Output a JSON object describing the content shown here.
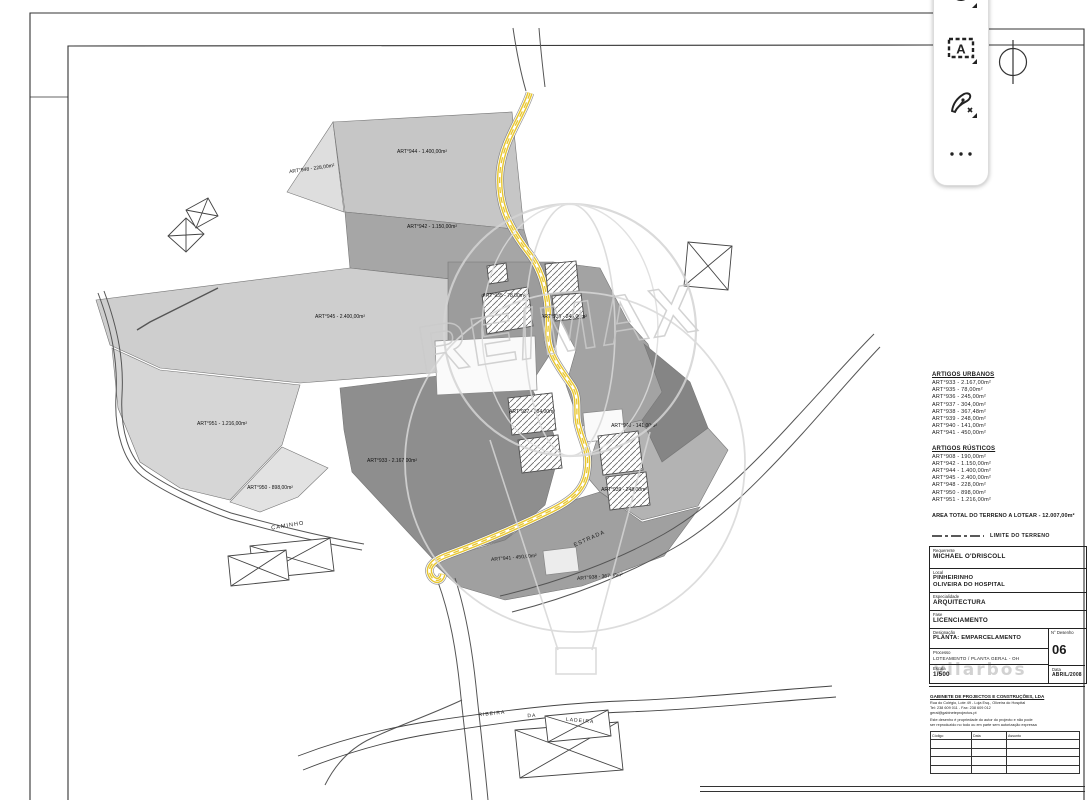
{
  "toolbar": {
    "icons": [
      "rotate-icon",
      "text-selection-icon",
      "pen-icon",
      "more-options-icon"
    ]
  },
  "plan": {
    "watermark": "RE/MAX",
    "caminho": "CAMINHO",
    "estrada": "ESTRADA",
    "stream": [
      "RIBEIRA",
      "DA",
      "LADEIRA"
    ],
    "labels": [
      "ART°948 - 228,00m²",
      "ART°944 - 1.400,00m²",
      "ART°942 - 1.150,00m²",
      "ART°945 - 2.400,00m²",
      "ART°951 - 1.216,00m²",
      "ART°950 - 898,00m²",
      "ART°935 - 78,00m²",
      "ART°936 - 245,00m²",
      "ART°937 - 304,00m²",
      "ART°940 - 141,00m²",
      "ART°939 - 248,00m²",
      "ART°941 - 450,00m²",
      "ART°938 - 367,48m²",
      "ART°933 - 2.167,00m²"
    ]
  },
  "panel": {
    "urban_title": "ARTIGOS URBANOS",
    "urban": [
      "ART°933 - 2.167,00m²",
      "ART°935 - 78,00m²",
      "ART°936 - 245,00m²",
      "ART°937 - 304,00m²",
      "ART°938 - 367,48m²",
      "ART°939 - 248,00m²",
      "ART°940 - 141,00m²",
      "ART°941 - 450,00m²"
    ],
    "rustic_title": "ARTIGOS RÚSTICOS",
    "rustic": [
      "ART°908 - 190,00m²",
      "ART°942 - 1.150,00m²",
      "ART°944 - 1.400,00m²",
      "ART°945 - 2.400,00m²",
      "ART°948 - 228,00m²",
      "ART°950 - 898,00m²",
      "ART°951 - 1.216,00m²"
    ],
    "total": "AREA TOTAL DO TERRENO A LOTEAR - 12.007,00m²",
    "legend": "LIMITE DO TERRENO",
    "fields": {
      "requerente_label": "Requerente",
      "requerente": "MICHAEL O'DRISCOLL",
      "local_label": "Local",
      "local_line1": "PINHEIRINHO",
      "local_line2": "OLIVEIRA DO HOSPITAL",
      "especialidade_label": "Especialidade",
      "especialidade": "ARQUITECTURA",
      "fase_label": "Fase",
      "fase": "LICENCIAMENTO",
      "designacao_label": "Designação",
      "designacao": "PLANTA: EMPARCELAMENTO",
      "processo_label": "Processo",
      "processo": "LOTEAMENTO / PLANTA GERAL - OH",
      "num_label": "N° Desenho",
      "num": "06",
      "escala_label": "Escala",
      "escala": "1/500",
      "data_label": "Data",
      "data": "ABRIL/2008"
    },
    "firm_watermark": "vilarbos",
    "company": {
      "name": "GABINETE DE PROJECTOS E CONSTRUÇÕES, LDA",
      "addr1": "Rua do Colégio, Lote 49 - Loja Esq., Oliveira do Hospital",
      "addr2": "Tel: 238 609 011  -  Fax: 238 609 012",
      "addr3": "geral@gabineteprojectos.pt",
      "note1": "Este desenho é propriedade do autor do projecto e não pode",
      "note2": "ser reproduzido no todo ou em parte sem autorização expressa",
      "rev_headers": [
        "Código",
        "Data",
        "Assunto"
      ]
    }
  },
  "colors": {
    "road_highlight": "#e8c62e",
    "watermark_gray": "#d2d2d2",
    "parcel_dark": "#8e8e8e",
    "parcel_light": "#cecece"
  }
}
